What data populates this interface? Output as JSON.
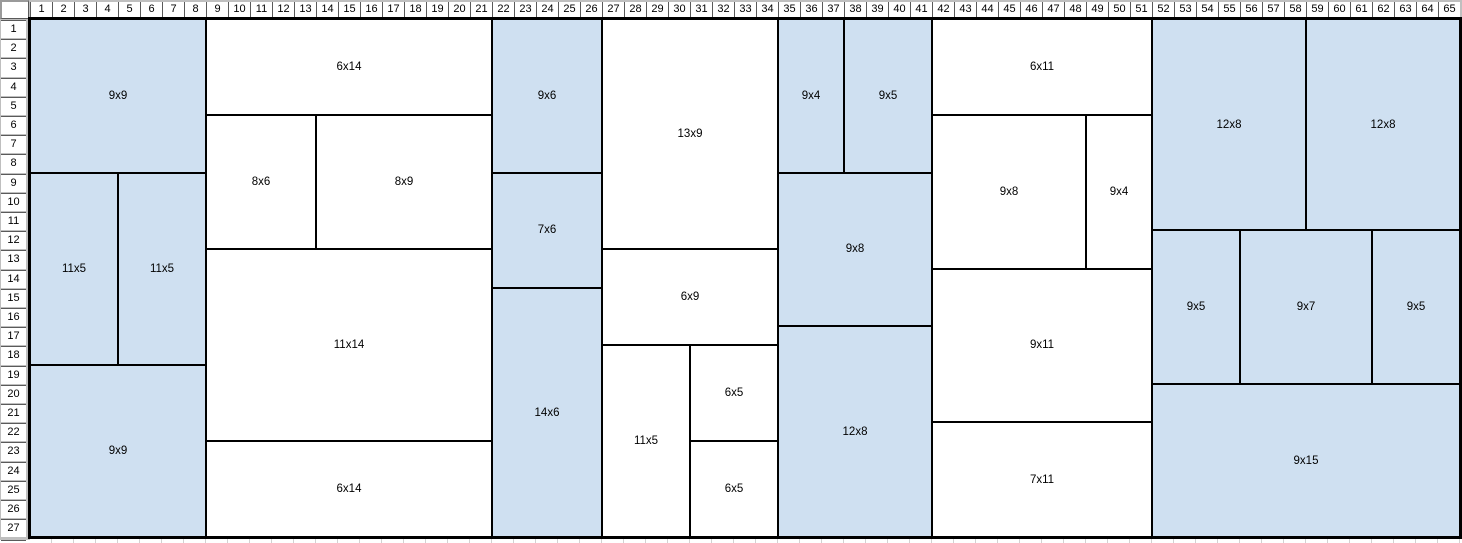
{
  "app": "spreadsheet-packing-view",
  "colors": {
    "fill_blue": "#cfe0f1",
    "fill_white": "#ffffff",
    "rect_border": "#000000",
    "header_bg": "#bfbfbf",
    "header_cell": "#ffffff",
    "header_text": "#000000",
    "faint_grid": "#d2d2d2"
  },
  "grid": {
    "columns": [
      1,
      2,
      3,
      4,
      5,
      6,
      7,
      8,
      9,
      10,
      11,
      12,
      13,
      14,
      15,
      16,
      17,
      18,
      19,
      20,
      21,
      22,
      23,
      24,
      25,
      26,
      27,
      28,
      29,
      30,
      31,
      32,
      33,
      34,
      35,
      36,
      37,
      38,
      39,
      40,
      41,
      42,
      43,
      44,
      45,
      46,
      47,
      48,
      49,
      50,
      51,
      52,
      53,
      54,
      55,
      56,
      57,
      58,
      59,
      60,
      61,
      62,
      63,
      64,
      65
    ],
    "rows": [
      1,
      2,
      3,
      4,
      5,
      6,
      7,
      8,
      9,
      10,
      11,
      12,
      13,
      14,
      15,
      16,
      17,
      18,
      19,
      20,
      21,
      22,
      23,
      24,
      25,
      26,
      27
    ]
  },
  "rects": [
    {
      "label": "9x9",
      "fill": "blue",
      "c1": 1,
      "r1": 1,
      "c2": 8,
      "r2": 8
    },
    {
      "label": "11x5",
      "fill": "blue",
      "c1": 1,
      "r1": 9,
      "c2": 4,
      "r2": 18
    },
    {
      "label": "11x5",
      "fill": "blue",
      "c1": 5,
      "r1": 9,
      "c2": 8,
      "r2": 18
    },
    {
      "label": "9x9",
      "fill": "blue",
      "c1": 1,
      "r1": 19,
      "c2": 8,
      "r2": 27
    },
    {
      "label": "6x14",
      "fill": "white",
      "c1": 9,
      "r1": 1,
      "c2": 21,
      "r2": 5
    },
    {
      "label": "8x6",
      "fill": "white",
      "c1": 9,
      "r1": 6,
      "c2": 13,
      "r2": 12
    },
    {
      "label": "8x9",
      "fill": "white",
      "c1": 14,
      "r1": 6,
      "c2": 21,
      "r2": 12
    },
    {
      "label": "11x14",
      "fill": "white",
      "c1": 9,
      "r1": 13,
      "c2": 21,
      "r2": 22
    },
    {
      "label": "6x14",
      "fill": "white",
      "c1": 9,
      "r1": 23,
      "c2": 21,
      "r2": 27
    },
    {
      "label": "9x6",
      "fill": "blue",
      "c1": 22,
      "r1": 1,
      "c2": 26,
      "r2": 8
    },
    {
      "label": "7x6",
      "fill": "blue",
      "c1": 22,
      "r1": 9,
      "c2": 26,
      "r2": 14
    },
    {
      "label": "14x6",
      "fill": "blue",
      "c1": 22,
      "r1": 15,
      "c2": 26,
      "r2": 27
    },
    {
      "label": "13x9",
      "fill": "white",
      "c1": 27,
      "r1": 1,
      "c2": 34,
      "r2": 12
    },
    {
      "label": "6x9",
      "fill": "white",
      "c1": 27,
      "r1": 13,
      "c2": 34,
      "r2": 17
    },
    {
      "label": "11x5",
      "fill": "white",
      "c1": 27,
      "r1": 18,
      "c2": 30,
      "r2": 27
    },
    {
      "label": "6x5",
      "fill": "white",
      "c1": 31,
      "r1": 18,
      "c2": 34,
      "r2": 22
    },
    {
      "label": "6x5",
      "fill": "white",
      "c1": 31,
      "r1": 23,
      "c2": 34,
      "r2": 27
    },
    {
      "label": "9x4",
      "fill": "blue",
      "c1": 35,
      "r1": 1,
      "c2": 37,
      "r2": 8
    },
    {
      "label": "9x5",
      "fill": "blue",
      "c1": 38,
      "r1": 1,
      "c2": 41,
      "r2": 8
    },
    {
      "label": "9x8",
      "fill": "blue",
      "c1": 35,
      "r1": 9,
      "c2": 41,
      "r2": 16
    },
    {
      "label": "12x8",
      "fill": "blue",
      "c1": 35,
      "r1": 17,
      "c2": 41,
      "r2": 27
    },
    {
      "label": "6x11",
      "fill": "white",
      "c1": 42,
      "r1": 1,
      "c2": 51,
      "r2": 5
    },
    {
      "label": "9x8",
      "fill": "white",
      "c1": 42,
      "r1": 6,
      "c2": 48,
      "r2": 13
    },
    {
      "label": "9x4",
      "fill": "white",
      "c1": 49,
      "r1": 6,
      "c2": 51,
      "r2": 13
    },
    {
      "label": "9x11",
      "fill": "white",
      "c1": 42,
      "r1": 14,
      "c2": 51,
      "r2": 21
    },
    {
      "label": "7x11",
      "fill": "white",
      "c1": 42,
      "r1": 22,
      "c2": 51,
      "r2": 27
    },
    {
      "label": "12x8",
      "fill": "blue",
      "c1": 52,
      "r1": 1,
      "c2": 58,
      "r2": 11
    },
    {
      "label": "12x8",
      "fill": "blue",
      "c1": 59,
      "r1": 1,
      "c2": 65,
      "r2": 11
    },
    {
      "label": "9x5",
      "fill": "blue",
      "c1": 52,
      "r1": 12,
      "c2": 55,
      "r2": 19
    },
    {
      "label": "9x7",
      "fill": "blue",
      "c1": 56,
      "r1": 12,
      "c2": 61,
      "r2": 19
    },
    {
      "label": "9x5",
      "fill": "blue",
      "c1": 62,
      "r1": 12,
      "c2": 65,
      "r2": 19
    },
    {
      "label": "9x15",
      "fill": "blue",
      "c1": 52,
      "r1": 20,
      "c2": 65,
      "r2": 27
    }
  ]
}
